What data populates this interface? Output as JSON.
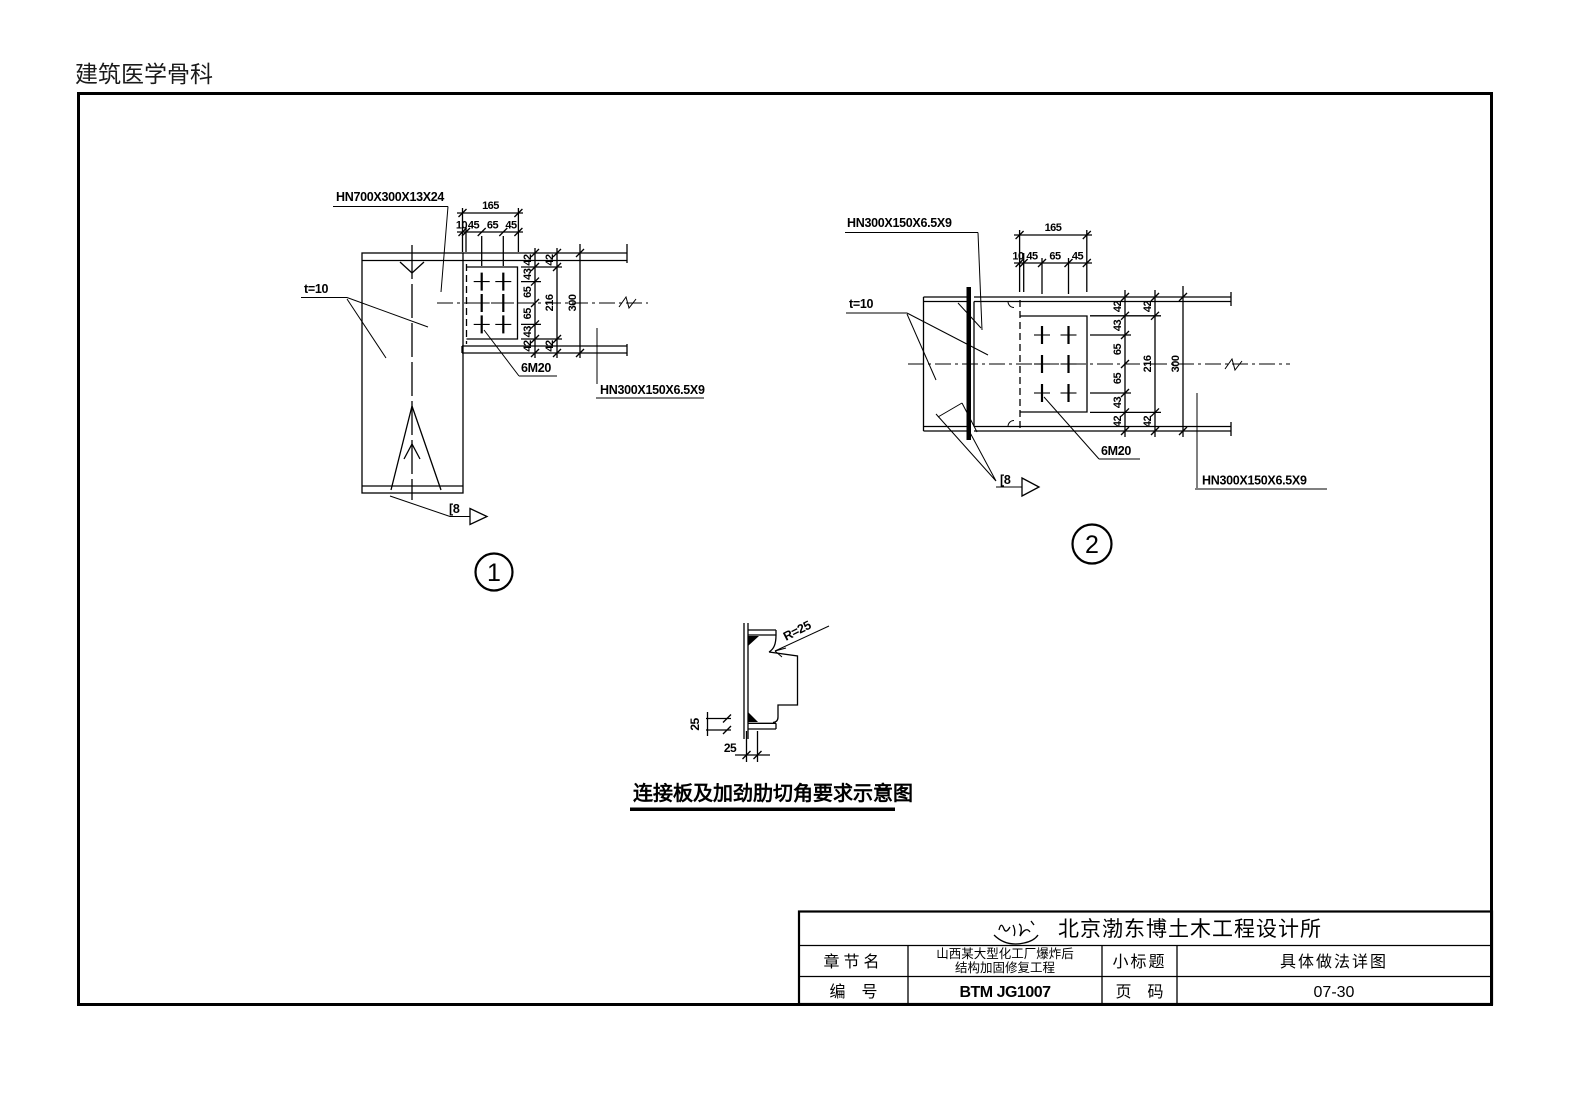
{
  "header": {
    "doc_title": "建筑医学骨科"
  },
  "colors": {
    "line": "#000000",
    "paper": "#ffffff"
  },
  "detail1": {
    "number": "1",
    "label_column": "HN700X300X13X24",
    "label_beam": "HN300X150X6.5X9",
    "label_plate": "t=10",
    "label_bolts": "6M20",
    "label_weld": "[8",
    "dim_top_total": "165",
    "dim_top": [
      "10",
      "45",
      "65",
      "45"
    ],
    "dim_right_chain": [
      "42",
      "43",
      "65",
      "65",
      "43",
      "42"
    ],
    "dim_right_mid": [
      "42",
      "216",
      "42"
    ],
    "dim_right_total": "300"
  },
  "detail2": {
    "number": "2",
    "label_beam_top": "HN300X150X6.5X9",
    "label_beam_right": "HN300X150X6.5X9",
    "label_plate": "t=10",
    "label_bolts": "6M20",
    "label_weld": "[8",
    "dim_top_total": "165",
    "dim_top": [
      "10",
      "45",
      "65",
      "45"
    ],
    "dim_right_chain": [
      "42",
      "43",
      "65",
      "65",
      "43",
      "42"
    ],
    "dim_right_mid": [
      "42",
      "216",
      "42"
    ],
    "dim_right_total": "300"
  },
  "corner_detail": {
    "label_radius": "R=25",
    "dim_side": "25",
    "dim_bottom": "25",
    "caption": "连接板及加劲肋切角要求示意图"
  },
  "title_block": {
    "company": "北京渤东博土木工程设计所",
    "logo_icon": "signature-seal-icon",
    "row_chapter": {
      "label": "章节名",
      "value_line1": "山西某大型化工厂爆炸后",
      "value_line2": "结构加固修复工程"
    },
    "row_subtitle": {
      "label": "小标题",
      "value": "具体做法详图"
    },
    "row_number": {
      "label": "编　号",
      "value": "BTM JG1007"
    },
    "row_page": {
      "label": "页　码",
      "value": "07-30"
    }
  }
}
